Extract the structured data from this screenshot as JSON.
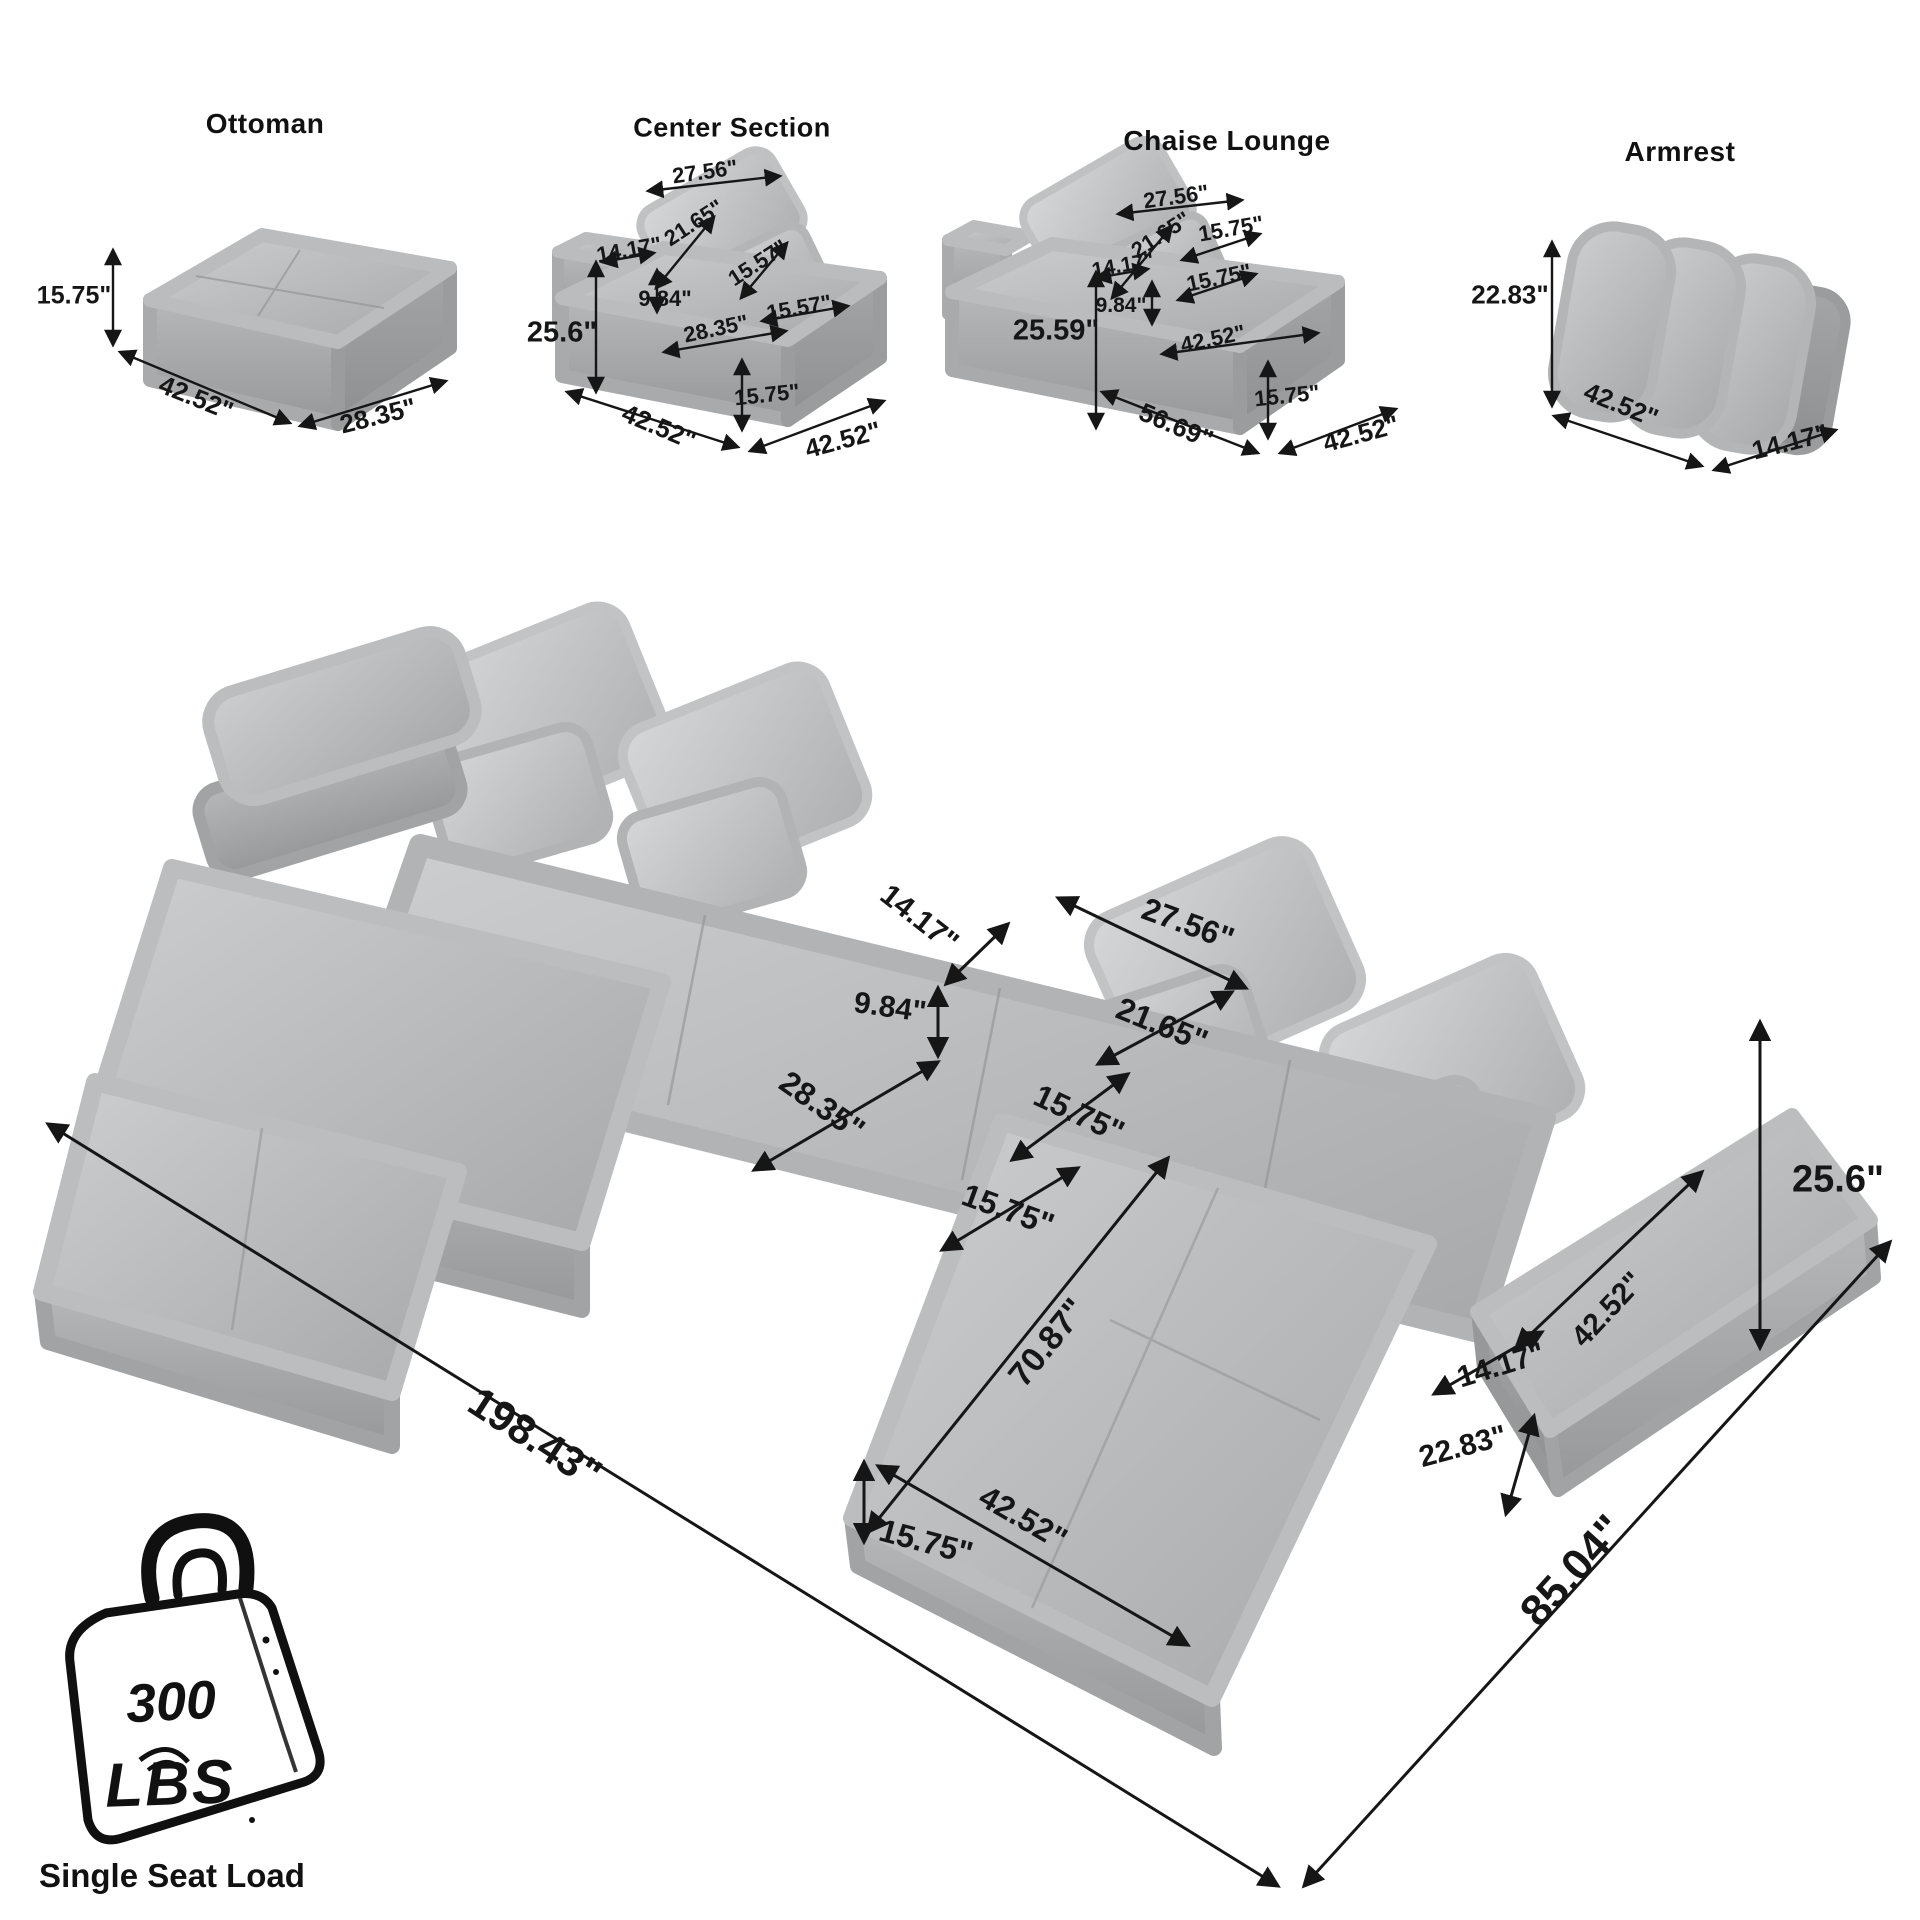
{
  "modules": {
    "ottoman": {
      "title": "Ottoman",
      "height": "15.75\"",
      "width": "42.52\"",
      "depth": "28.35\""
    },
    "center_section": {
      "title": "Center Section",
      "pillow_width": "27.56\"",
      "pillow_height": "21.65\"",
      "small_pillow_height": "15.57\"",
      "small_pillow_width": "15.57\"",
      "back_depth": "14.17\"",
      "back_above_seat": "9.84\"",
      "total_height": "25.6\"",
      "seat_depth": "28.35\"",
      "seat_height": "15.75\"",
      "width": "42.52\"",
      "depth": "42.52\""
    },
    "chaise_lounge": {
      "title": "Chaise Lounge",
      "pillow_width": "27.56\"",
      "pillow_height": "21.65\"",
      "small_pillow_width": "15.75\"",
      "small_pillow_height": "15.75\"",
      "back_depth": "14.17\"",
      "back_above_seat": "9.84\"",
      "total_height": "25.59\"",
      "seat_width": "42.52\"",
      "total_depth": "56.69\"",
      "seat_height": "15.75\"",
      "width": "42.52\""
    },
    "armrest": {
      "title": "Armrest",
      "height": "22.83\"",
      "width": "42.52\"",
      "depth": "14.17\""
    }
  },
  "main_diagram": {
    "back_depth": "14.17\"",
    "back_above_seat": "9.84\"",
    "seat_depth": "28.35\"",
    "pillow_width": "27.56\"",
    "pillow_height": "21.65\"",
    "small_pillow_height": "15.75\"",
    "small_pillow_width": "15.75\"",
    "total_height": "25.6\"",
    "armrest_length": "42.52\"",
    "armrest_width": "14.17\"",
    "armrest_height": "22.83\"",
    "chaise_length": "70.87\"",
    "chaise_width": "42.52\"",
    "seat_height": "15.75\"",
    "total_length": "198.43\"",
    "total_depth": "85.04\""
  },
  "load_badge": {
    "value": "300",
    "unit": "LBS",
    "caption": "Single Seat Load"
  }
}
